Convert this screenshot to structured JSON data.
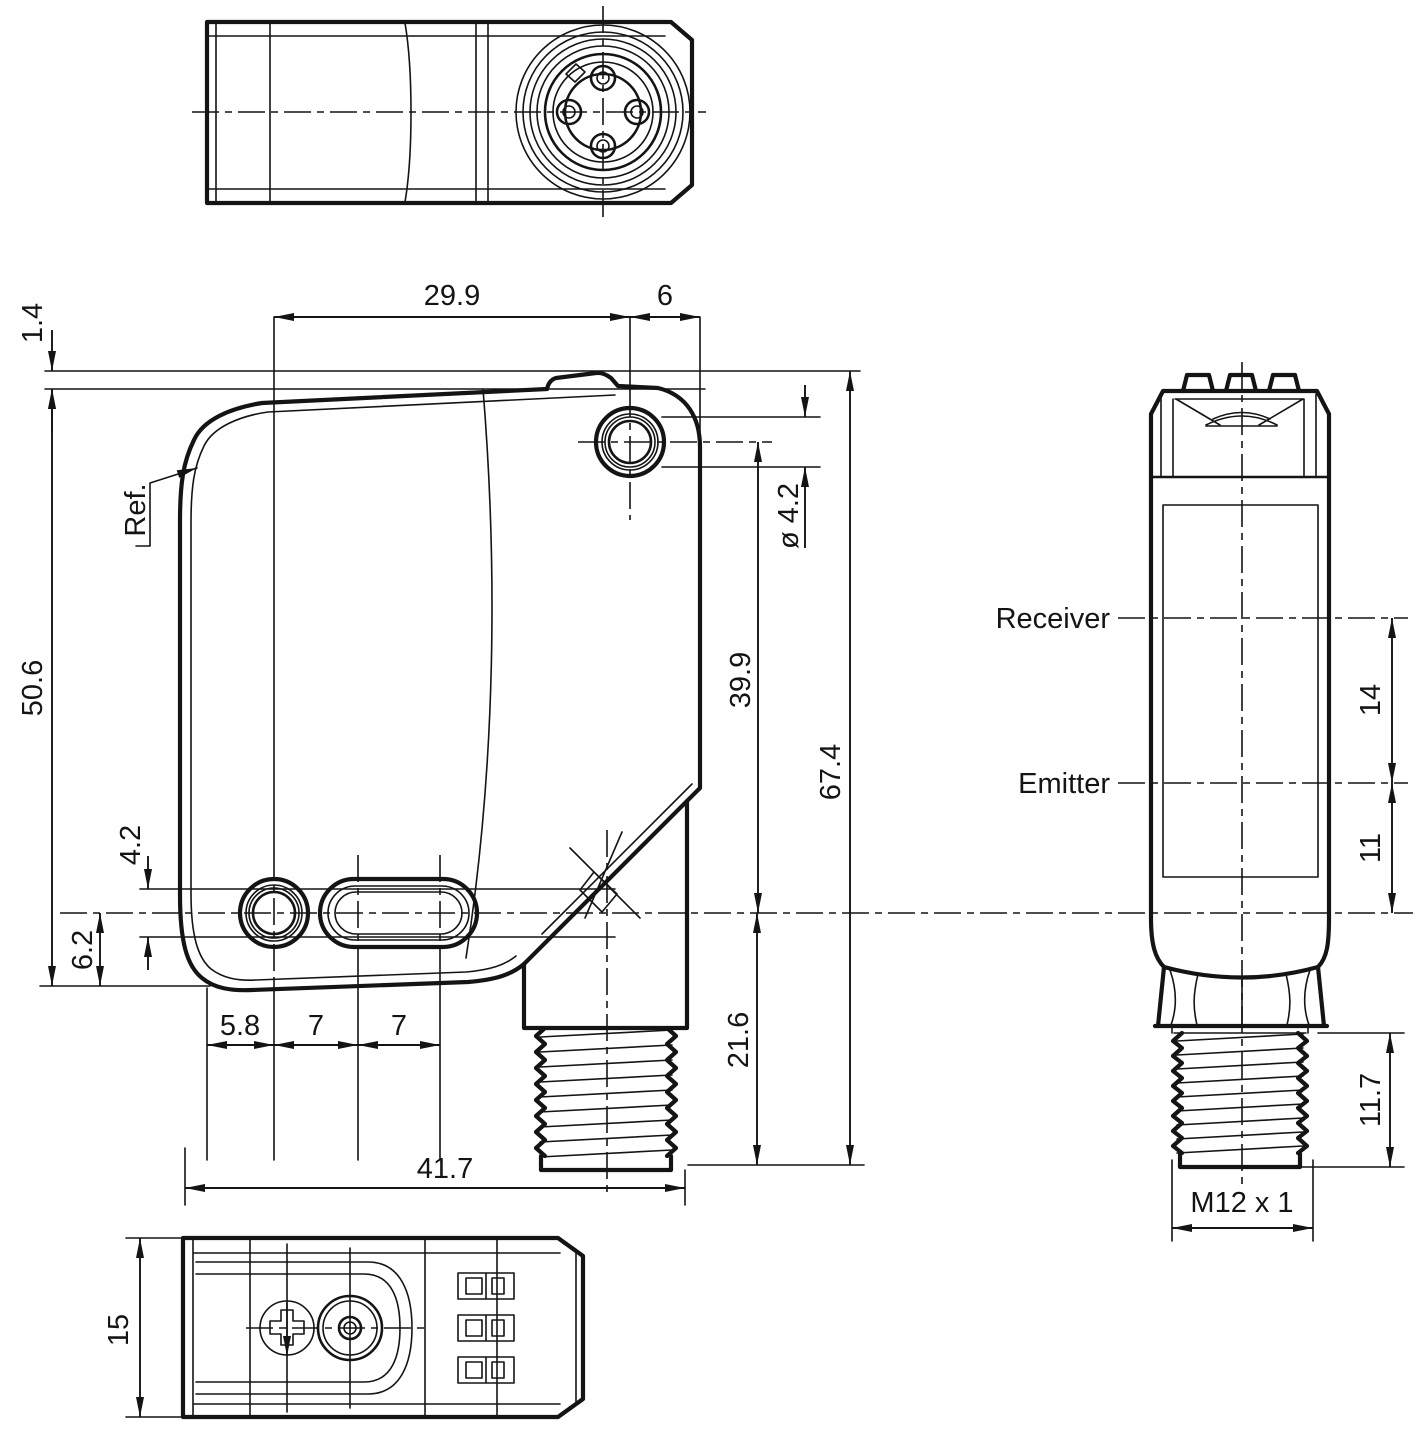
{
  "drawing": {
    "background": "#ffffff",
    "line_color": "#141414",
    "labels": {
      "ref": "Ref.",
      "receiver": "Receiver",
      "emitter": "Emitter"
    },
    "dims": {
      "d29_9": "29.9",
      "d6": "6",
      "d1_4": "1.4",
      "d50_6": "50.6",
      "d4_2": "4.2",
      "d6_2": "6.2",
      "d5_8": "5.8",
      "d7a": "7",
      "d7b": "7",
      "d41_7": "41.7",
      "dia4_2": "ø 4.2",
      "d39_9": "39.9",
      "d67_4": "67.4",
      "d21_6": "21.6",
      "d15": "15",
      "d14": "14",
      "d11": "11",
      "d11_7": "11.7",
      "m12": "M12 x 1"
    }
  }
}
